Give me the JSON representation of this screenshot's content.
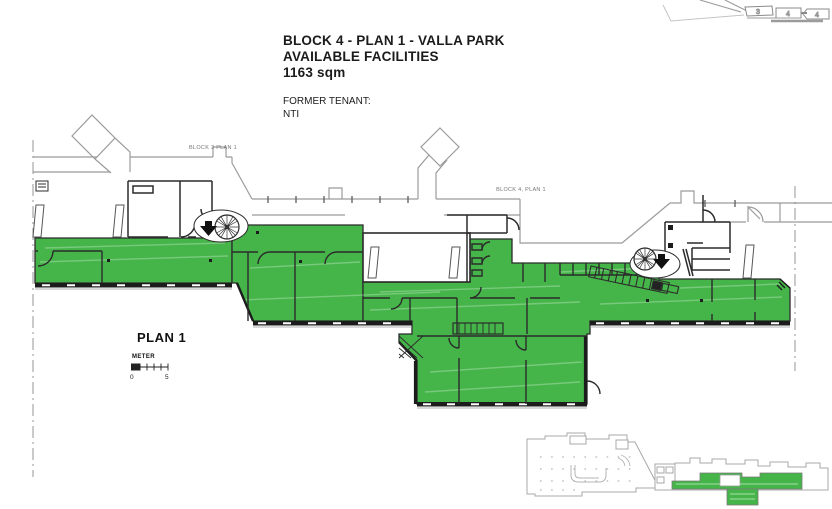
{
  "document": {
    "title_line1": "BLOCK 4 - PLAN 1 - VALLA PARK",
    "title_line2": "AVAILABLE FACILITIES",
    "title_line3": "1163 sqm",
    "former_tenant_label": "FORMER TENANT:",
    "former_tenant_name": "NTI"
  },
  "plan": {
    "name": "PLAN 1",
    "scale_unit": "METER",
    "scale_start": "0",
    "scale_end": "5",
    "label_block3": "BLOCK 3 PLAN 1",
    "label_block4": "BLOCK 4, PLAN 1"
  },
  "key_plan": {
    "block3": "3",
    "block4a": "4",
    "block4b": "4"
  },
  "colors": {
    "available_area": "#45b549",
    "wall": "#2b2b2b",
    "envelope": "#9b9b9b"
  }
}
